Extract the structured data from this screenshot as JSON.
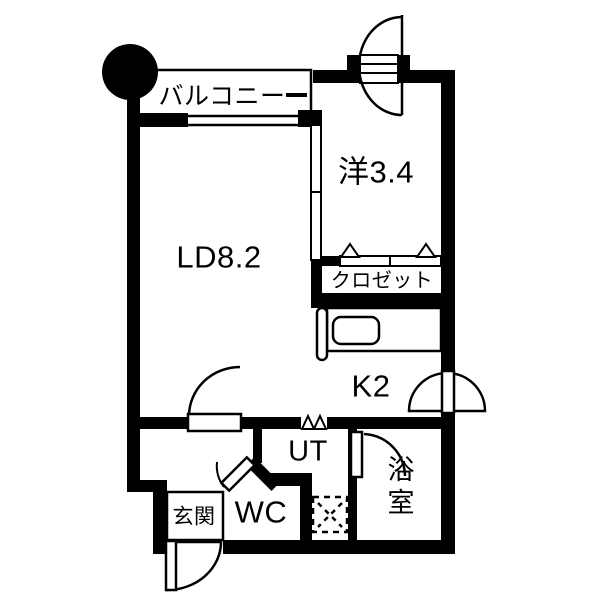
{
  "floorplan": {
    "rooms": {
      "balcony": "バルコニー",
      "western_room": "洋3.4",
      "living_dining": "LD8.2",
      "closet": "クロゼット",
      "kitchen": "K2",
      "utility": "UT",
      "toilet": "WC",
      "bathroom": "浴室",
      "entrance": "玄関"
    },
    "colors": {
      "wall": "#000000",
      "background": "#ffffff"
    },
    "fixtures": [
      "north-marker-circle",
      "balcony-window",
      "sliding-partition",
      "closet-folding-door",
      "kitchen-counter",
      "kitchen-sink",
      "washing-machine-pan",
      "entry-door",
      "room-swing-door",
      "hall-swing-door",
      "bathroom-swing-door",
      "wc-swing-door",
      "exterior-swing-door",
      "utility-folding-door"
    ]
  }
}
